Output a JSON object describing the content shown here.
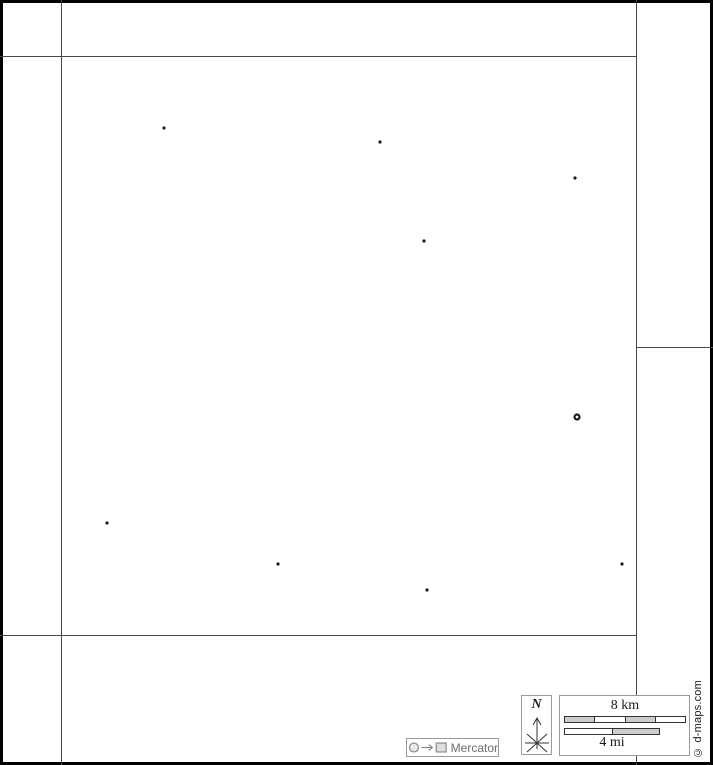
{
  "map": {
    "background": "#ffffff",
    "border_color": "#000000",
    "line_color": "#474747",
    "markers": {
      "city_color": "#1a1a1a",
      "cities": [
        {
          "x": 164,
          "y": 128
        },
        {
          "x": 380,
          "y": 142
        },
        {
          "x": 575,
          "y": 178
        },
        {
          "x": 424,
          "y": 241
        },
        {
          "x": 107,
          "y": 523
        },
        {
          "x": 278,
          "y": 564
        },
        {
          "x": 427,
          "y": 590
        },
        {
          "x": 622,
          "y": 564
        }
      ],
      "capital": {
        "x": 577,
        "y": 417
      }
    }
  },
  "compass": {
    "north_label": "N"
  },
  "scale": {
    "km_label": "8 km",
    "mi_label": "4 mi",
    "bar_border": "#333333",
    "km_segments": [
      "#cccccc",
      "#ffffff",
      "#cccccc",
      "#ffffff"
    ],
    "mi_segments": [
      "#ffffff",
      "#cccccc"
    ]
  },
  "projection": {
    "label": "Mercator",
    "icon_color": "#8a8a8a",
    "text_color": "#6e6e6e"
  },
  "copyright": {
    "text": "© d-maps.com"
  }
}
